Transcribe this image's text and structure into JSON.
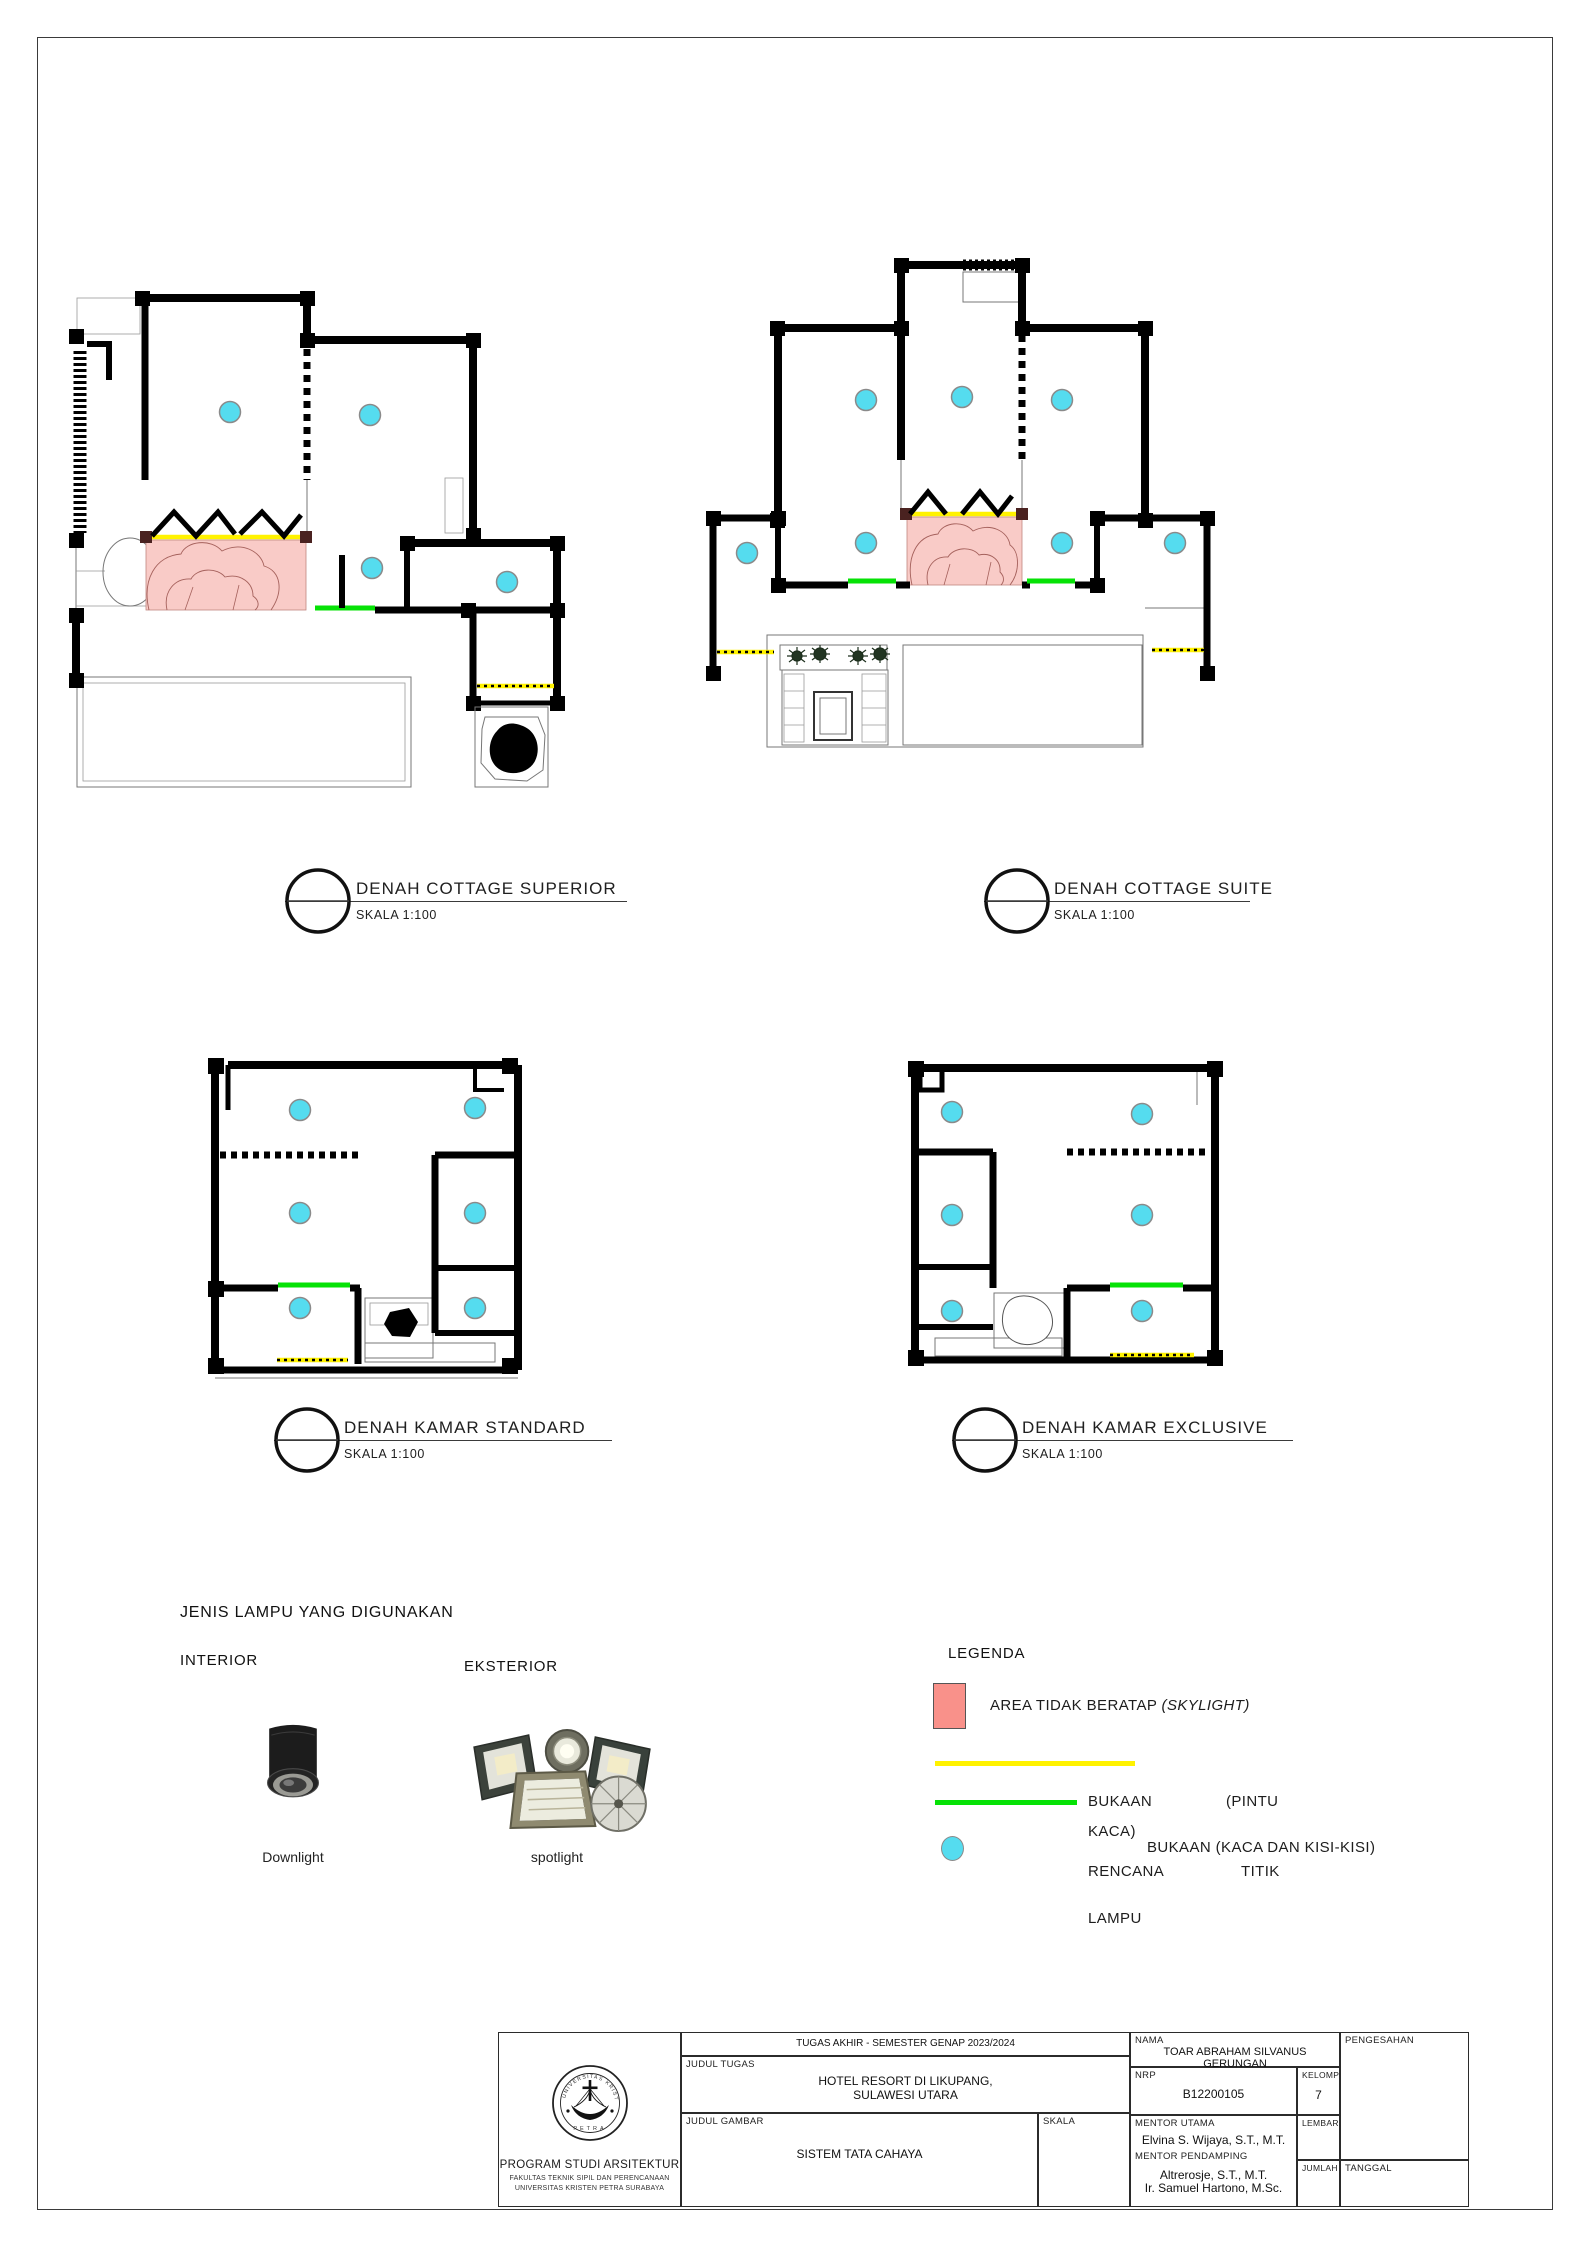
{
  "plans": [
    {
      "title": "DENAH COTTAGE SUPERIOR",
      "scale": "SKALA 1:100",
      "lamp_points": 4
    },
    {
      "title": "DENAH COTTAGE SUITE",
      "scale": "SKALA 1:100",
      "lamp_points": 7
    },
    {
      "title": "DENAH KAMAR STANDARD",
      "scale": "SKALA 1:100",
      "lamp_points": 6
    },
    {
      "title": "DENAH KAMAR EXCLUSIVE",
      "scale": "SKALA 1:100",
      "lamp_points": 6
    }
  ],
  "lamp_section": {
    "heading": "JENIS LAMPU YANG DIGUNAKAN",
    "interior_label": "INTERIOR",
    "exterior_label": "EKSTERIOR",
    "downlight_label": "Downlight",
    "spotlight_label": "spotlight"
  },
  "legend": {
    "heading": "LEGENDA",
    "skylight_text": "AREA TIDAK BERATAP ",
    "skylight_italic": "(SKYLIGHT)",
    "bukaan_pintu_word1": "BUKAAN",
    "bukaan_pintu_word2": "(PINTU",
    "bukaan_pintu_word3": "KACA)",
    "bukaan_kisi_label": "BUKAAN (KACA DAN KISI-KISI)",
    "rencana_word1": "RENCANA",
    "rencana_word2": "TITIK",
    "rencana_word3": "LAMPU"
  },
  "title_block": {
    "course": "TUGAS AKHIR - SEMESTER GENAP 2023/2024",
    "judul_tugas_label": "JUDUL TUGAS",
    "judul_tugas_line1": "HOTEL RESORT DI LIKUPANG,",
    "judul_tugas_line2": "SULAWESI UTARA",
    "judul_gambar_label": "JUDUL GAMBAR",
    "judul_gambar_value": "SISTEM TATA CAHAYA",
    "skala_label": "SKALA",
    "nama_label": "NAMA",
    "nama_value": "TOAR ABRAHAM SILVANUS GERUNGAN",
    "nrp_label": "NRP",
    "nrp_value": "B12200105",
    "kelompok_label": "KELOMPOK",
    "kelompok_value": "7",
    "mentor_utama_label": "MENTOR UTAMA",
    "mentor_utama_value": "Elvina S. Wijaya, S.T., M.T.",
    "mentor_pendamping_label": "MENTOR PENDAMPING",
    "mentor_pendamping_value1": "Altrerosje, S.T., M.T.",
    "mentor_pendamping_value2": "Ir. Samuel Hartono, M.Sc.",
    "lembar_label": "LEMBAR",
    "jumlah_label": "JUMLAH",
    "pengesahan_label": "PENGESAHAN",
    "tanggal_label": "TANGGAL",
    "institution": {
      "name": "PROGRAM STUDI ARSITEKTUR",
      "faculty": "FAKULTAS TEKNIK SIPIL DAN PERENCANAAN",
      "university": "UNIVERSITAS KRISTEN PETRA SURABAYA",
      "seal_top": "UNIVERSITAS KRISTEN",
      "seal_bottom": "PETRA"
    }
  },
  "colors": {
    "skylight_swatch": "#F9918A",
    "skylight_area": "#F9CBC7",
    "bukaan_kaca_kisi": "#FFF200",
    "bukaan_pintu_kaca": "#06E206",
    "titik_lampu": "#55DCEF"
  }
}
